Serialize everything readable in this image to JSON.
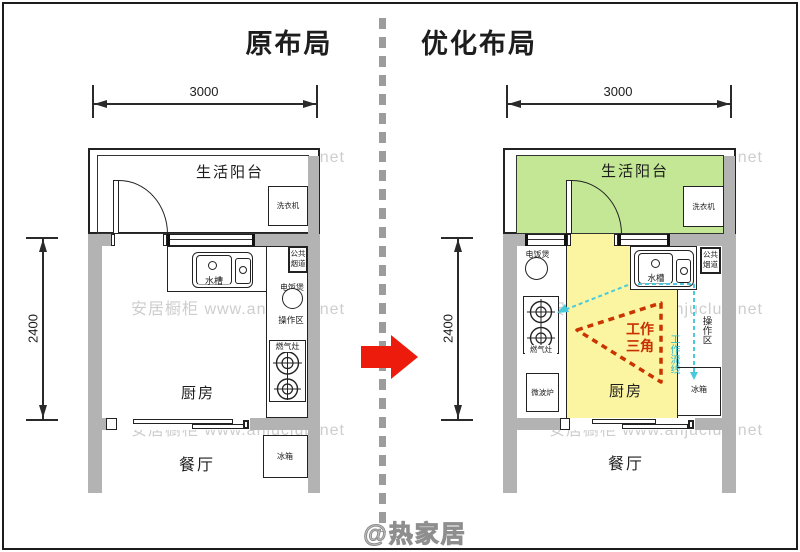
{
  "titles": {
    "left": "原布局",
    "right": "优化布局"
  },
  "dims": {
    "width": "3000",
    "height": "2400"
  },
  "rooms": {
    "balcony": "生活阳台",
    "kitchen": "厨房",
    "dining": "餐厅"
  },
  "items": {
    "washer": "洗衣机",
    "sink": "水槽",
    "flue1": "公共",
    "flue2": "烟道",
    "rice_cooker": "电饭煲",
    "prep_area": "操作区",
    "stove": "燃气灶",
    "microwave": "微波炉",
    "fridge": "冰箱"
  },
  "annotations": {
    "triangle1": "工作",
    "triangle2": "三角",
    "flow": "工作流线"
  },
  "page": {
    "watermark": "安居橱柜 www.anjuclub.net",
    "credit": "@热家居"
  },
  "colors": {
    "wall_gray": "#b3b3b3",
    "balcony_green": "#c3e795",
    "kitchen_yellow": "#fbf5a1",
    "arrow_red": "#ec1b0b",
    "triangle_red": "#c93400",
    "flow_cyan": "#4ac9db",
    "divider_gray": "#9c9c9c"
  }
}
